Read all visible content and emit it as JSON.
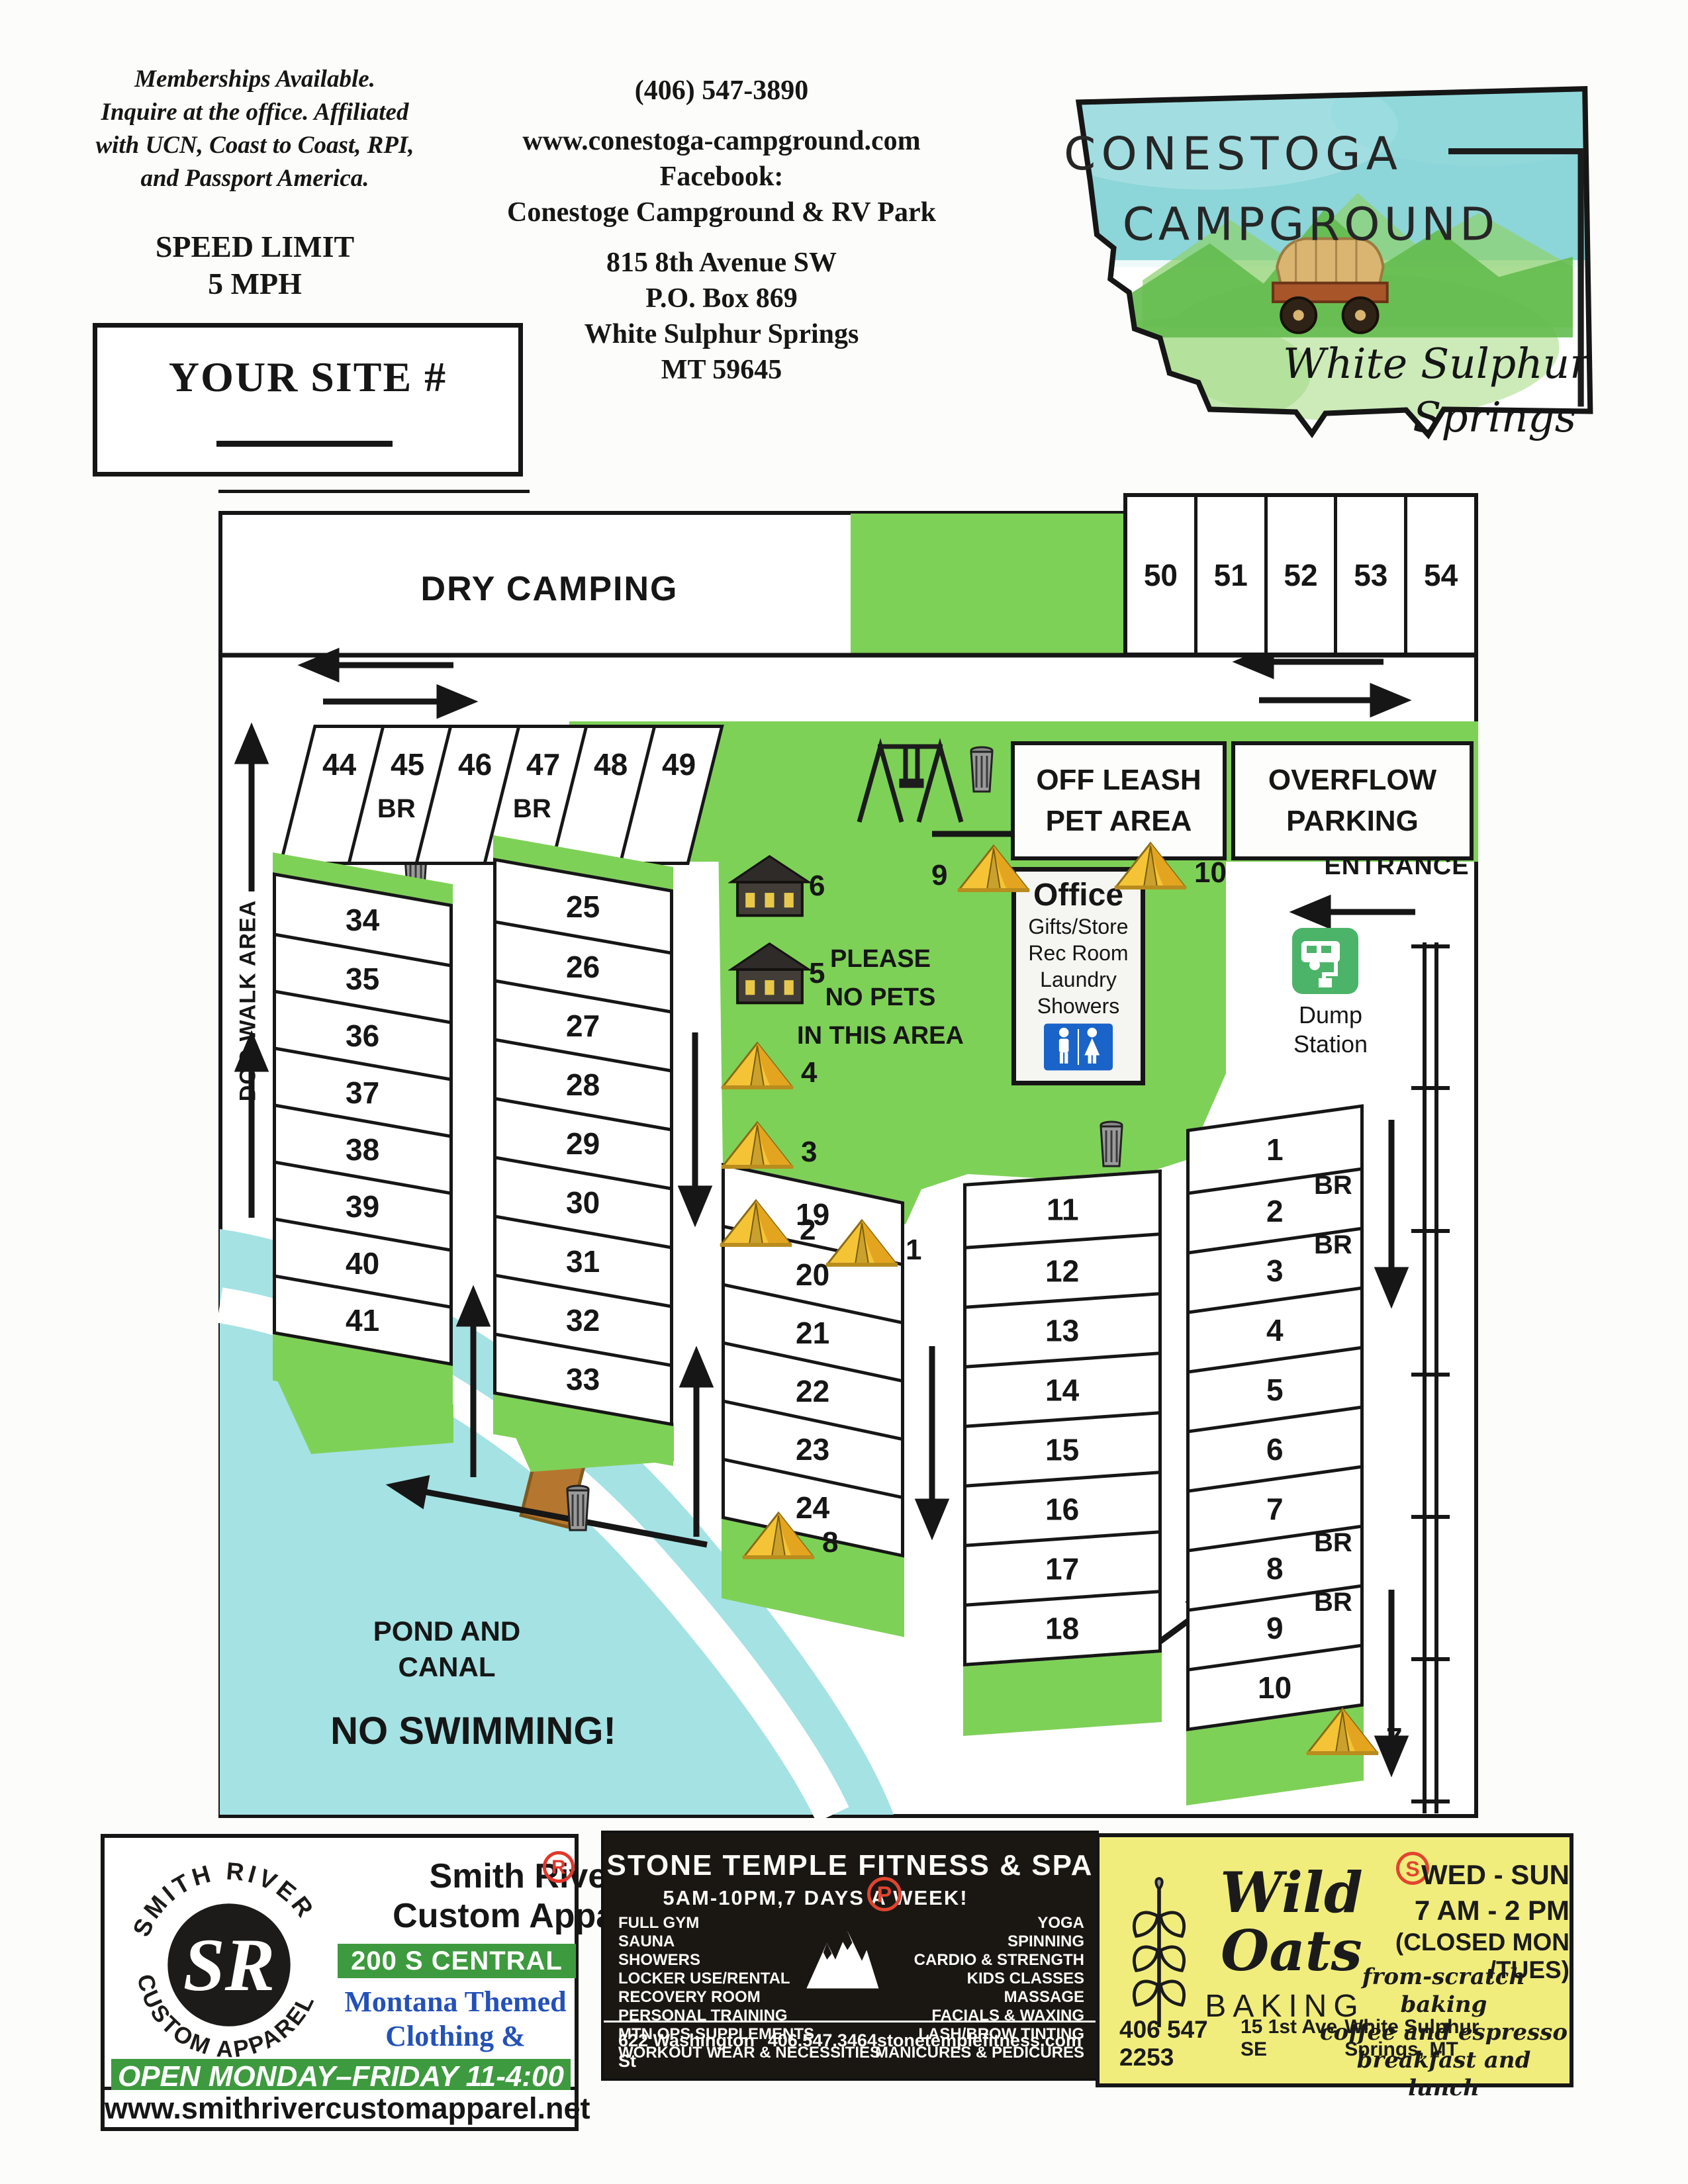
{
  "colors": {
    "map_green": "#7ed157",
    "pond_blue": "#a5e2e4",
    "restroom_blue": "#1a63c9",
    "dump_green": "#4cb469",
    "tent_yellow": "#f5c436",
    "smith_green": "#3e9a3e",
    "smith_blue": "#2451b8",
    "badge_red": "#e2372b",
    "stone_black": "#1a1713",
    "wild_yellow": "#f1ed7c"
  },
  "header": {
    "memberships_lines": [
      "Memberships Available.",
      "Inquire at the office.  Affiliated",
      "with UCN, Coast to Coast, RPI,",
      "and Passport America."
    ],
    "speed_limit_lines": [
      "SPEED LIMIT",
      "5 MPH"
    ],
    "your_site_label": "YOUR SITE #",
    "contact": {
      "phone": "(406) 547-3890",
      "website": "www.conestoga-campground.com",
      "facebook_label": "Facebook:",
      "facebook_page": "Conestoge Campground & RV Park",
      "address_lines": [
        "815 8th Avenue SW",
        "P.O. Box 869",
        "White Sulphur Springs",
        "MT 59645"
      ]
    },
    "logo": {
      "name_line1": "CONESTOGA",
      "name_line2": "CAMPGROUND",
      "script_line1": "White Sulphur",
      "script_line2": "Springs"
    }
  },
  "map": {
    "dry_camping_label": "DRY CAMPING",
    "top_sites": [
      "50",
      "51",
      "52",
      "53",
      "54"
    ],
    "row_44_49": [
      {
        "num": "44",
        "br": ""
      },
      {
        "num": "45",
        "br": "BR"
      },
      {
        "num": "46",
        "br": ""
      },
      {
        "num": "47",
        "br": "BR"
      },
      {
        "num": "48",
        "br": ""
      },
      {
        "num": "49",
        "br": ""
      }
    ],
    "off_leash_lines": [
      "OFF LEASH",
      "PET AREA"
    ],
    "overflow_lines": [
      "OVERFLOW",
      "PARKING"
    ],
    "entrance_label": "ENTRANCE",
    "dump_station_lines": [
      "Dump",
      "Station"
    ],
    "dog_walk_label": "DOG WALK AREA",
    "col_34_41": [
      "34",
      "35",
      "36",
      "37",
      "38",
      "39",
      "40",
      "41"
    ],
    "col_25_33": [
      "25",
      "26",
      "27",
      "28",
      "29",
      "30",
      "31",
      "32",
      "33"
    ],
    "col_19_24": [
      "19",
      "20",
      "21",
      "22",
      "23",
      "24"
    ],
    "col_11_18": [
      "11",
      "12",
      "13",
      "14",
      "15",
      "16",
      "17",
      "18"
    ],
    "col_1_10": [
      {
        "num": "1",
        "br": ""
      },
      {
        "num": "2",
        "br": "BR"
      },
      {
        "num": "3",
        "br": "BR"
      },
      {
        "num": "4",
        "br": ""
      },
      {
        "num": "5",
        "br": ""
      },
      {
        "num": "6",
        "br": ""
      },
      {
        "num": "7",
        "br": ""
      },
      {
        "num": "8",
        "br": "BR"
      },
      {
        "num": "9",
        "br": "BR"
      },
      {
        "num": "10",
        "br": ""
      }
    ],
    "no_pets_lines": [
      "PLEASE",
      "NO PETS",
      "IN THIS AREA"
    ],
    "office": {
      "title": "Office",
      "services": [
        "Gifts/Store",
        "Rec Room",
        "Laundry",
        "Showers"
      ]
    },
    "pond_lines": [
      "POND AND",
      "CANAL"
    ],
    "no_swimming_label": "NO SWIMMING!",
    "tent_numbers": {
      "t1": "1",
      "t2": "2",
      "t3": "3",
      "t4": "4",
      "t7": "7",
      "t8": "8",
      "t9": "9",
      "t10": "10"
    },
    "cabin_numbers": {
      "c5": "5",
      "c6": "6"
    }
  },
  "ads": {
    "smith": {
      "logo_text_top": "SMITH RIVER",
      "logo_text_bottom": "CUSTOM APPAREL",
      "logo_monogram": "SR",
      "name_line1": "Smith River",
      "name_line2": "Custom Apparel",
      "registered_mark": "R",
      "address_band": "200 S CENTRAL AVE",
      "tagline_line1": "Montana Themed",
      "tagline_line2": "Clothing & Souvenirs",
      "hours_band": "OPEN MONDAY–FRIDAY 11-4:00",
      "website": "www.smithrivercustomapparel.net"
    },
    "stone": {
      "title": "STONE TEMPLE FITNESS & SPA",
      "hours": "5AM-10PM,7 DAYS A WEEK!",
      "p_badge": "P",
      "services_left": [
        "FULL GYM",
        "SAUNA",
        "SHOWERS",
        "LOCKER USE/RENTAL",
        "RECOVERY ROOM",
        "PERSONAL TRAINING",
        "MTN OPS SUPPLEMENTS",
        "WORKOUT WEAR & NECESSITIES"
      ],
      "services_right": [
        "YOGA",
        "SPINNING",
        "CARDIO & STRENGTH",
        "KIDS CLASSES",
        "MASSAGE",
        "FACIALS & WAXING",
        "LASH/BROW TINTING",
        "MANICURES & PEDICURES"
      ],
      "address": "622 Washington St",
      "phone": "406.547.3464",
      "website": "stonetemplefitness.com"
    },
    "wild": {
      "s_badge": "S",
      "script_line1": "Wild",
      "script_line2": "Oats",
      "baking": "BAKING",
      "days": "WED - SUN",
      "hours": "7 AM - 2 PM",
      "closed": "(CLOSED MON /TUES)",
      "tag_lines": [
        "from-scratch baking",
        "coffee and espresso",
        "breakfast and lunch"
      ],
      "phone": "406 547 2253",
      "address": "15 1st Ave SE",
      "city": "White Sulphur Springs, MT"
    }
  }
}
